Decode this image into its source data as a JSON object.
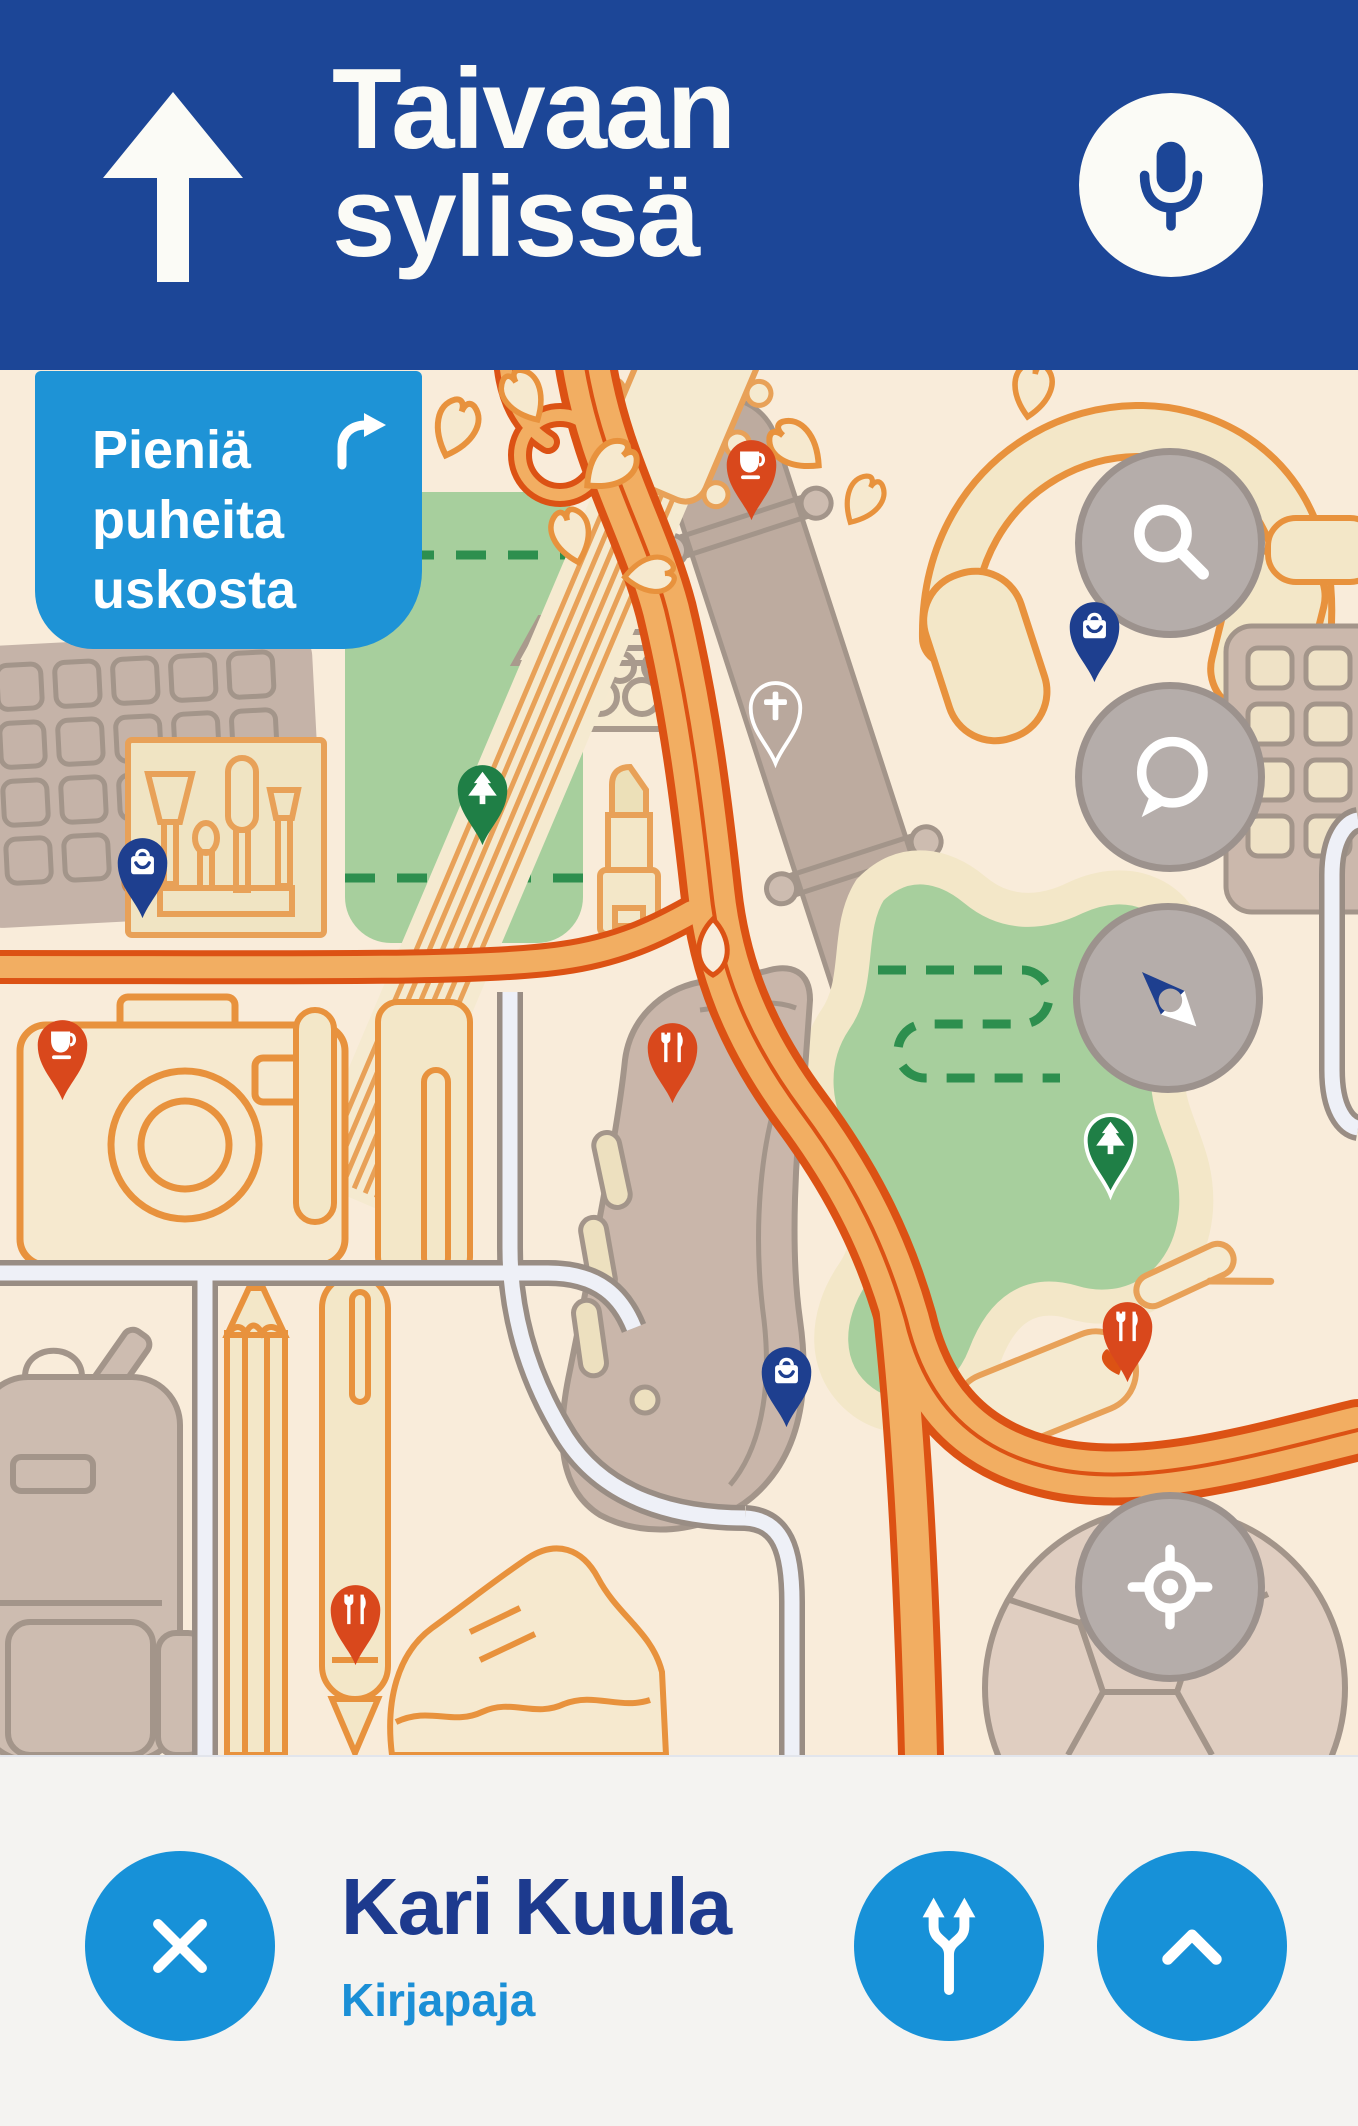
{
  "window": {
    "width": 1358,
    "height": 2126
  },
  "header": {
    "title_line1": "Taivaan",
    "title_line2": "sylissä",
    "bg_color": "#1c4697",
    "text_color": "#fbfbf6",
    "straight_arrow_icon": "up-arrow",
    "mic_icon": "microphone",
    "mic_icon_color": "#1c4697"
  },
  "speech_bubble": {
    "lines": [
      "Pieniä",
      "puheita",
      "uskosta"
    ],
    "bg_color": "#1e93d6",
    "text_color": "#ffffff",
    "icon": "turn-right-arrow"
  },
  "map": {
    "bg_color": "#f9ecda",
    "road_fill": "#f2ae62",
    "road_casing": "#dc5214",
    "minor_outline": "#e8923d",
    "park_color": "#a7cf9d",
    "trail_color": "#2d8f4e",
    "object_tan": "#c5b3a8",
    "object_outline": "#a3958a",
    "object_cream": "#f3e7c8",
    "street_fill": "#eef0f7",
    "street_casing": "#998d84",
    "control_bg": "#b5adaa",
    "control_border": "#9c928d",
    "controls": [
      {
        "id": "search",
        "icon": "search",
        "x": 1170,
        "y": 543
      },
      {
        "id": "chat",
        "icon": "chat",
        "x": 1170,
        "y": 777
      },
      {
        "id": "compass",
        "icon": "compass",
        "x": 1168,
        "y": 998
      },
      {
        "id": "locate",
        "icon": "locate",
        "x": 1170,
        "y": 1587
      }
    ],
    "pins": [
      {
        "type": "cafe",
        "x": 751,
        "y": 465,
        "color": "#d9481c"
      },
      {
        "type": "shopping",
        "x": 1094,
        "y": 627,
        "color": "#1e3f8f"
      },
      {
        "type": "church",
        "x": 775,
        "y": 708,
        "color": "#b9a89d",
        "outlined": true
      },
      {
        "type": "park",
        "x": 482,
        "y": 790,
        "color": "#1f7f46"
      },
      {
        "type": "shopping",
        "x": 142,
        "y": 863,
        "color": "#1e3f8f"
      },
      {
        "type": "cafe",
        "x": 62,
        "y": 1045,
        "color": "#d9481c"
      },
      {
        "type": "restaurant",
        "x": 672,
        "y": 1048,
        "color": "#d9481c"
      },
      {
        "type": "park",
        "x": 1110,
        "y": 1140,
        "color": "#1f7f46",
        "outlined": true
      },
      {
        "type": "restaurant",
        "x": 1127,
        "y": 1327,
        "color": "#d9481c"
      },
      {
        "type": "shopping",
        "x": 786,
        "y": 1372,
        "color": "#1e3f8f"
      },
      {
        "type": "restaurant",
        "x": 355,
        "y": 1610,
        "color": "#d9481c"
      }
    ],
    "landmarks": [
      "computer-keyboard",
      "makeup-brush-kit",
      "egg-carton",
      "phone-park",
      "lipstick",
      "guitar",
      "skateboard",
      "headphones",
      "number-pad",
      "camera",
      "pen",
      "pencil",
      "backpack",
      "sneaker",
      "running-shoe",
      "soccer-ball"
    ]
  },
  "bottom_bar": {
    "bg_color": "#f4f3f1",
    "author": "Kari Kuula",
    "author_color": "#1d3a8e",
    "publisher": "Kirjapaja",
    "publisher_color": "#1b8fd6",
    "button_color": "#1791d8",
    "close_icon": "x",
    "route_icon": "route-fork",
    "expand_icon": "chevron-up"
  }
}
